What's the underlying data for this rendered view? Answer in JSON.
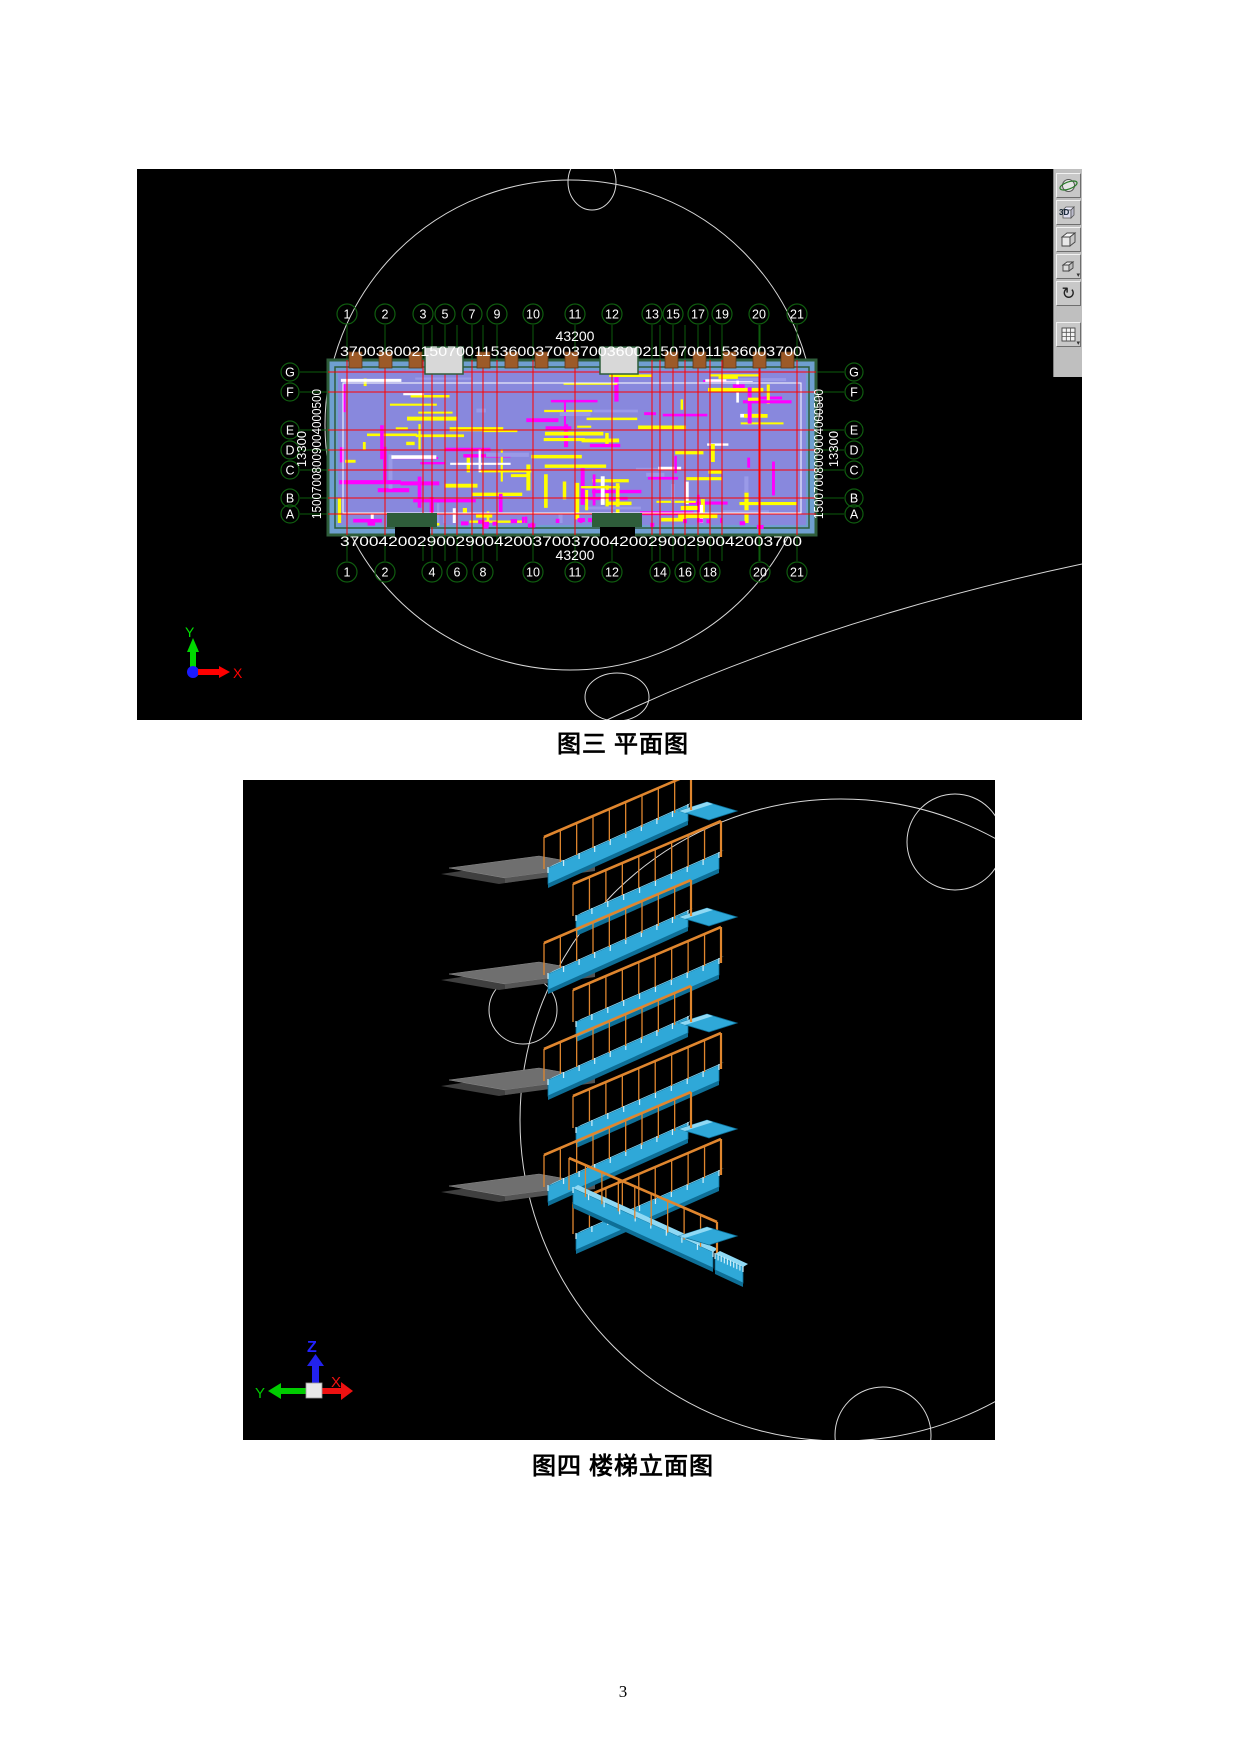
{
  "page": {
    "number": "3"
  },
  "toolbar": {
    "orbit_icon": "orbit",
    "threeD_label": "3D",
    "rotate_glyph": "↻",
    "dropdown_glyph": "▾"
  },
  "figure_plan": {
    "caption": "图三 平面图",
    "top_axes": [
      "1",
      "2",
      "3",
      "5",
      "7",
      "9",
      "10",
      "11",
      "12",
      "13",
      "15",
      "17",
      "19",
      "20",
      "21"
    ],
    "bottom_axes": [
      "1",
      "2",
      "4",
      "6",
      "8",
      "10",
      "11",
      "12",
      "14",
      "16",
      "18",
      "20",
      "21"
    ],
    "row_axes": [
      "G",
      "F",
      "E",
      "D",
      "C",
      "B",
      "A"
    ],
    "top_total": "43200",
    "top_dims": "3700360021507001153600370037003600215070011536003700",
    "bottom_dims": "370042002900290042003700370042002900290042003700",
    "bottom_total": "43200",
    "side_total": "13300",
    "side_dims": "15007008009004000500",
    "ucs": {
      "x_label": "X",
      "y_label": "Y"
    }
  },
  "figure_stairs": {
    "caption": "图四 楼梯立面图",
    "ucs": {
      "x_label": "X",
      "y_label": "Y",
      "z_label": "Z"
    }
  },
  "colors": {
    "stair_cyan": "#2fa8d8",
    "stair_cyan_light": "#8fd9f4",
    "stair_cyan_dark": "#0e6f97",
    "railing_orange": "#e0862e",
    "landing_gray": "#6f6f6f",
    "slab_blue": "#6f9fd0",
    "interior_violet": "#8888dd",
    "grid_green": "#0c5c0c",
    "grid_red": "#ff0000",
    "rebar_yellow": "#ffff00",
    "rebar_magenta": "#ff00ff",
    "building_green": "#2e5d3a",
    "stub_brown": "#9c5a28"
  }
}
